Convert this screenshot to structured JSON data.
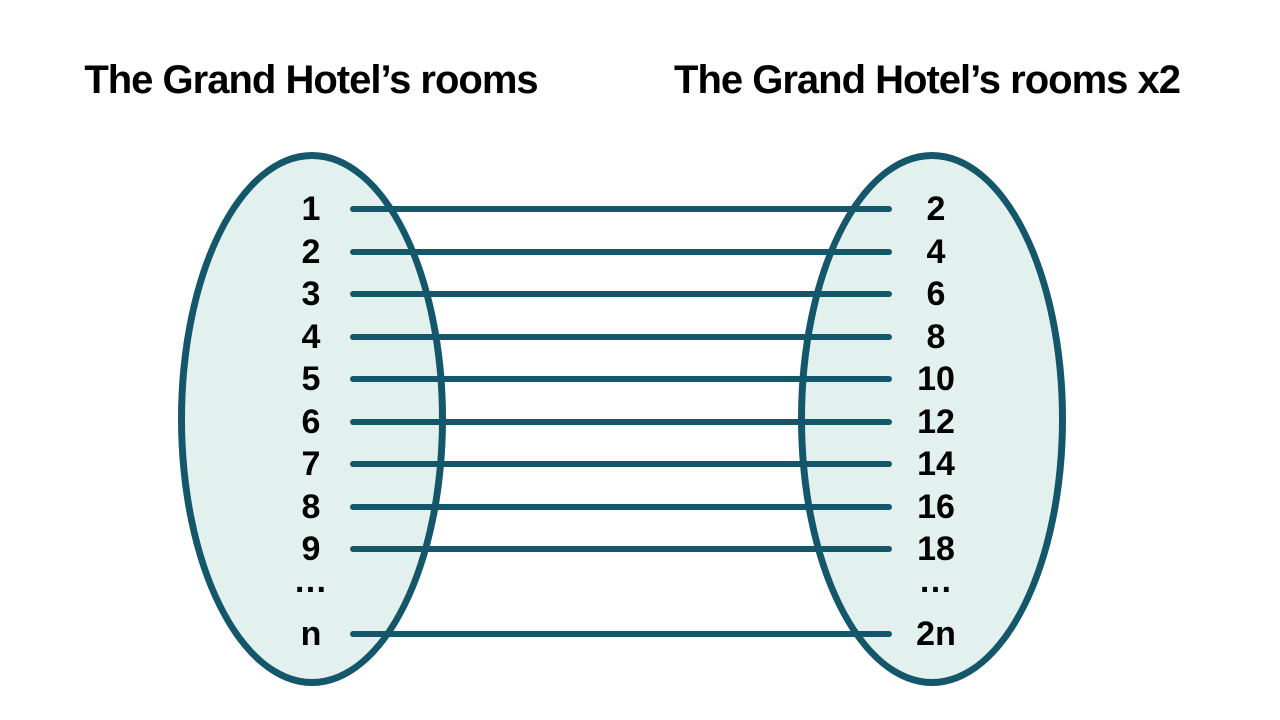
{
  "diagram": {
    "left_set": {
      "title": "The Grand Hotel’s rooms",
      "labels": [
        "1",
        "2",
        "3",
        "4",
        "5",
        "6",
        "7",
        "8",
        "9",
        "…",
        "n"
      ]
    },
    "right_set": {
      "title": "The Grand Hotel’s rooms x2",
      "labels": [
        "2",
        "4",
        "6",
        "8",
        "10",
        "12",
        "14",
        "16",
        "18",
        "…",
        "2n"
      ]
    },
    "connections": [
      {
        "from": "1",
        "to": "2"
      },
      {
        "from": "2",
        "to": "4"
      },
      {
        "from": "3",
        "to": "6"
      },
      {
        "from": "4",
        "to": "8"
      },
      {
        "from": "5",
        "to": "10"
      },
      {
        "from": "6",
        "to": "12"
      },
      {
        "from": "7",
        "to": "14"
      },
      {
        "from": "8",
        "to": "16"
      },
      {
        "from": "9",
        "to": "18"
      },
      {
        "from": "n",
        "to": "2n"
      }
    ]
  },
  "colors": {
    "set_fill": "#E3F1EE",
    "set_stroke": "#14576B",
    "connector_line": "#14576B",
    "text": "#000000",
    "background": "#FFFFFF"
  }
}
